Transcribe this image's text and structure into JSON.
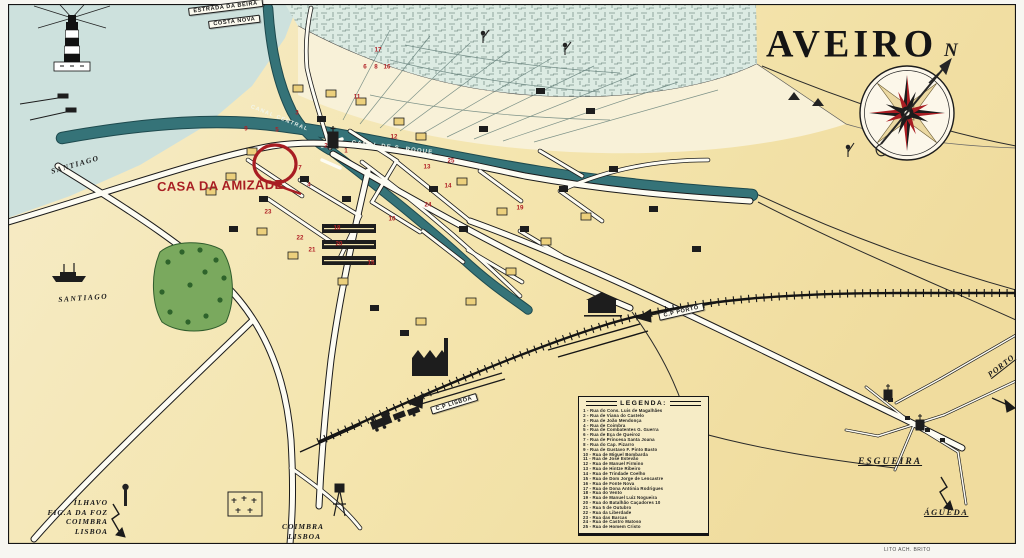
{
  "map": {
    "title": "AVEIRO",
    "credit": "LITO ACH. BRITO",
    "highlight": {
      "label": "CASA DA AMIZADE"
    },
    "compass": {
      "north": "N"
    },
    "colors": {
      "accent_red": "#a81d22",
      "canal_teal": "#357378",
      "lagoon_teal": "#dcebe3",
      "water_blue": "#cde1dd",
      "parchment": "#f4e5ae",
      "park_green": "#7aa95e"
    },
    "canals": {
      "central": "CANAL CENTRAL",
      "sao_roque": "CANAL DE S. ROQUE"
    },
    "ribbons": [
      {
        "text": "ESTRADA DA BEIRA",
        "x": 188,
        "y": 8,
        "a": -7
      },
      {
        "text": "COSTA NOVA",
        "x": 208,
        "y": 21,
        "a": -7
      },
      {
        "text": "C.P LISBOA",
        "x": 430,
        "y": 407,
        "a": -17
      },
      {
        "text": "C.P PORTO",
        "x": 658,
        "y": 313,
        "a": -13
      }
    ],
    "places": {
      "santiago_upper": "SANTIAGO",
      "santiago_lower": "SANTIAGO",
      "esgueira": "ESGUEIRA",
      "agueda": "ÁGUEDA",
      "porto": "PORTO"
    },
    "destinations_sw": [
      "ÍLHAVO",
      "FIG.A DA FOZ",
      "COIMBRA",
      "LISBOA"
    ],
    "destinations_s": [
      "COIMBRA",
      "LISBOA"
    ],
    "legend": {
      "title": "LEGENDA:",
      "items": [
        {
          "num": "1",
          "name": "Rua do Cons. Luis de Magalhães"
        },
        {
          "num": "2",
          "name": "Rua de Viana do Castelo"
        },
        {
          "num": "3",
          "name": "Rua de João Mendonça"
        },
        {
          "num": "4",
          "name": "Rua de Coimbra"
        },
        {
          "num": "5",
          "name": "Rua de Combatentes G. Guerra"
        },
        {
          "num": "6",
          "name": "Rua de Eça de Queiroz"
        },
        {
          "num": "7",
          "name": "Rua de Princesa Santa Joana"
        },
        {
          "num": "8",
          "name": "Rua do Cap. Pizarro"
        },
        {
          "num": "9",
          "name": "Rua de Gustavo F. Pinto Basto"
        },
        {
          "num": "10",
          "name": "Rua de Miguel Bombarda"
        },
        {
          "num": "11",
          "name": "Rua de José Estevão"
        },
        {
          "num": "12",
          "name": "Rua de Manuel Firmino"
        },
        {
          "num": "13",
          "name": "Rua de Hintze Ribeiro"
        },
        {
          "num": "14",
          "name": "Rua de Trindade Coelho"
        },
        {
          "num": "15",
          "name": "Rua de Dom Jorge de Lencastre"
        },
        {
          "num": "16",
          "name": "Rua de Fonte Nova"
        },
        {
          "num": "17",
          "name": "Rua de Dona Antónia Rodrigues"
        },
        {
          "num": "18",
          "name": "Rua do Vento"
        },
        {
          "num": "19",
          "name": "Rua de Manuel Luiz Nogueira"
        },
        {
          "num": "20",
          "name": "Rua do Batalhão Caçadores 10"
        },
        {
          "num": "21",
          "name": "Rua 5 de Outubro"
        },
        {
          "num": "22",
          "name": "Rua da Liberdade"
        },
        {
          "num": "23",
          "name": "Rua das Barcas"
        },
        {
          "num": "24",
          "name": "Rua de Castro Matoso"
        },
        {
          "num": "25",
          "name": "Rua de Homem Cristo"
        }
      ]
    },
    "street_markers": [
      {
        "n": "17",
        "x": 378,
        "y": 50
      },
      {
        "n": "6",
        "x": 365,
        "y": 67
      },
      {
        "n": "8",
        "x": 376,
        "y": 67
      },
      {
        "n": "16",
        "x": 387,
        "y": 67
      },
      {
        "n": "11",
        "x": 357,
        "y": 97
      },
      {
        "n": "3",
        "x": 297,
        "y": 113
      },
      {
        "n": "9",
        "x": 246,
        "y": 129
      },
      {
        "n": "5",
        "x": 277,
        "y": 130
      },
      {
        "n": "12",
        "x": 394,
        "y": 137
      },
      {
        "n": "2",
        "x": 326,
        "y": 146
      },
      {
        "n": "1",
        "x": 346,
        "y": 151
      },
      {
        "n": "25",
        "x": 451,
        "y": 161
      },
      {
        "n": "13",
        "x": 427,
        "y": 167
      },
      {
        "n": "7",
        "x": 300,
        "y": 168
      },
      {
        "n": "4",
        "x": 309,
        "y": 185
      },
      {
        "n": "14",
        "x": 448,
        "y": 186
      },
      {
        "n": "24",
        "x": 428,
        "y": 205
      },
      {
        "n": "19",
        "x": 520,
        "y": 208
      },
      {
        "n": "23",
        "x": 268,
        "y": 212
      },
      {
        "n": "10",
        "x": 392,
        "y": 219
      },
      {
        "n": "18",
        "x": 337,
        "y": 228
      },
      {
        "n": "22",
        "x": 300,
        "y": 238
      },
      {
        "n": "20",
        "x": 339,
        "y": 244
      },
      {
        "n": "21",
        "x": 312,
        "y": 250
      },
      {
        "n": "15",
        "x": 371,
        "y": 263
      }
    ]
  }
}
